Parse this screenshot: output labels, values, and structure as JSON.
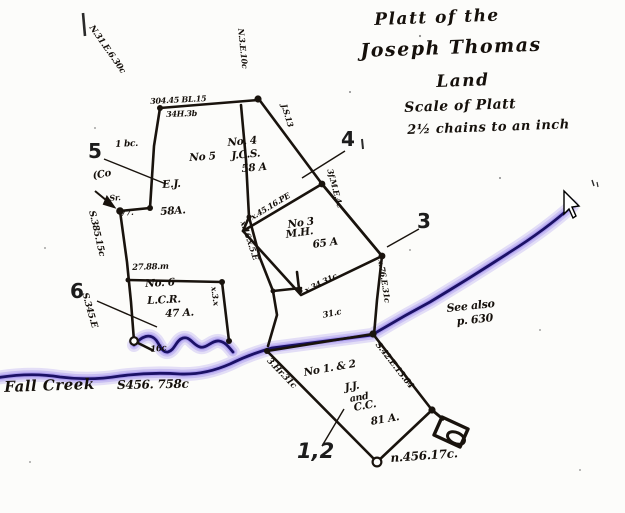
{
  "colors": {
    "paper": "#fcfcfa",
    "ink": "#19130d",
    "creek_glow": "#8d78ec",
    "creek_line": "#1b1166"
  },
  "title_block": {
    "lines": [
      "Platt of the",
      "Joseph Thomas",
      "Land",
      "Scale of Platt",
      "2½ chains to an inch"
    ]
  },
  "parcel_numbers": {
    "n5": "5",
    "n4": "4",
    "n3": "3",
    "n6": "6",
    "n12": "1,2"
  },
  "parcels": {
    "no4": {
      "name": "No. 4",
      "owner": "J.C.S.",
      "area": "58 A"
    },
    "no5": {
      "name": "No 5",
      "owner": "E.J.",
      "area": "58A."
    },
    "no3": {
      "name": "No 3",
      "owner": "M.H.",
      "area": "65 A"
    },
    "no6": {
      "name": "No. 6",
      "owner": "L.C.R.",
      "area": "47 A."
    },
    "no12": {
      "name": "No 1. & 2",
      "owner1": "J.J.",
      "conj": "and",
      "owner2": "C.C.",
      "area": "81 A."
    }
  },
  "creek": {
    "name": "Fall Creek",
    "survey": "S456. 758c"
  },
  "notes": {
    "see_also": "See also",
    "page_ref": "p. 630",
    "south_line": "n.456.17c."
  },
  "edge_notes": {
    "nw_diag": "N.31.E.6.30c",
    "top_above": "304.45 BL.15",
    "top_below": "34H.3b",
    "top_mid": "N.3.E.10c",
    "js": "J.S.13",
    "me": "3f.M.E.4c",
    "left_upper": "S.385.15c",
    "left_lower": "S.345.E",
    "bc": "1 bc.",
    "co": "(Co",
    "sr": "Sr.",
    "seven7": "77.",
    "no6_top": "27.88.m",
    "spine": "x.16.x.5.E",
    "p3_top": "x.45.16.PE",
    "p3_bottom": "x.34.31c",
    "p3_right": "x.76.E.31c",
    "p12_left": "3.Hr.31c",
    "p12_right": "S.42.E.13.64",
    "mid_31c": "31.c",
    "no6_right": "x.3.x",
    "creek_16c": "16c"
  }
}
